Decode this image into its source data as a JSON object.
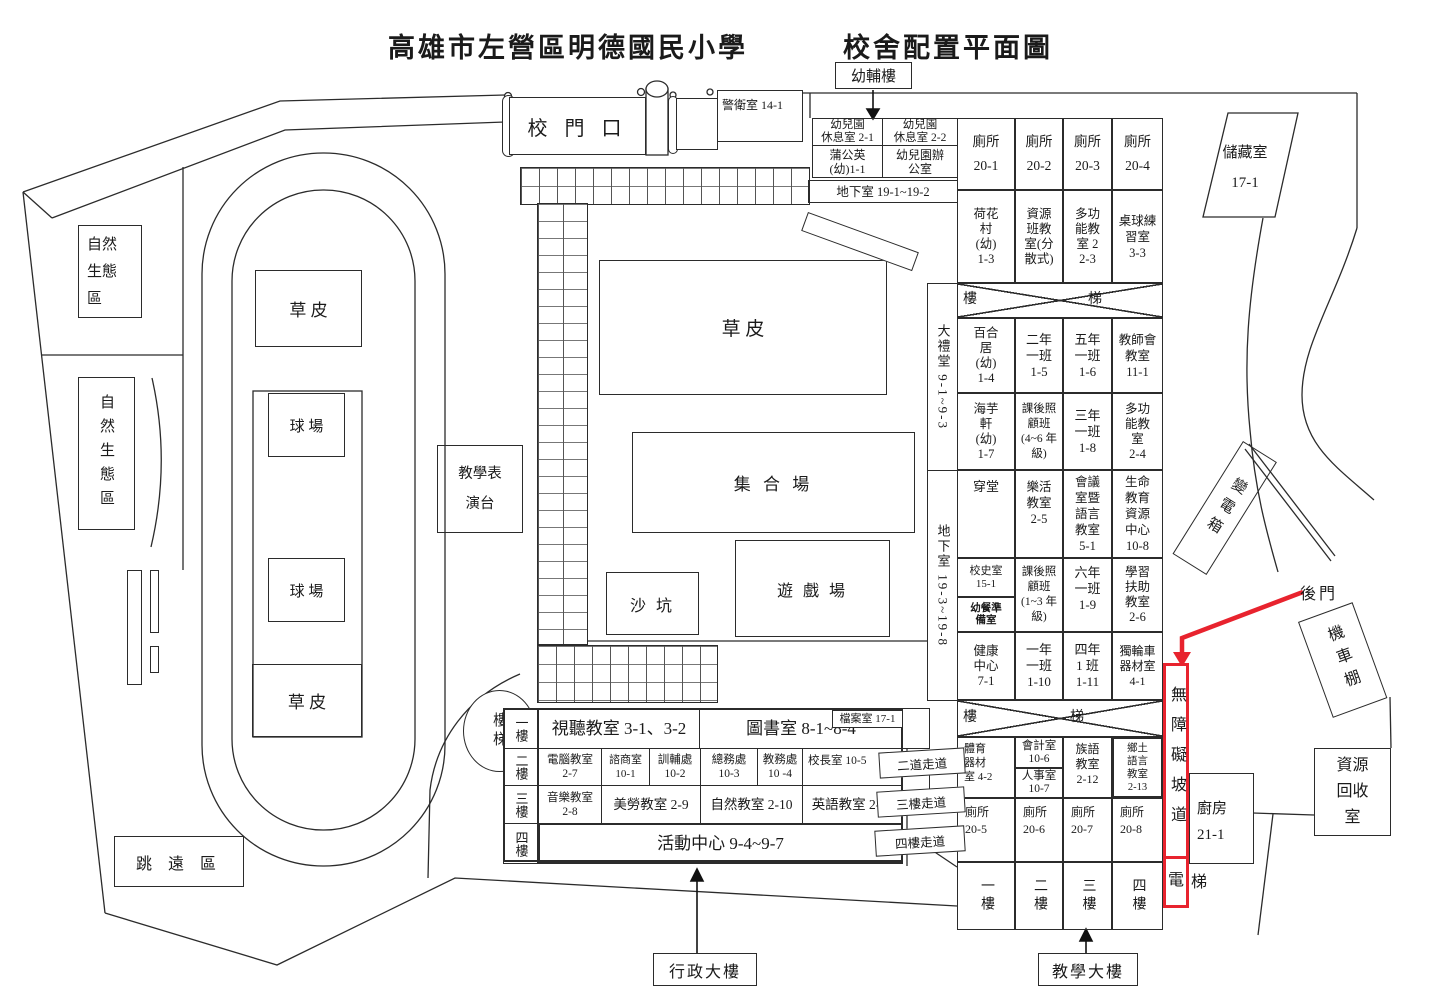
{
  "colors": {
    "ink": "#2b2b2b",
    "accent_red": "#e8232e"
  },
  "titles": {
    "school": "高雄市左營區明德國民小學",
    "map": "校舍配置平面圖"
  },
  "annotations": {
    "youfulou": "幼輔樓",
    "back_gate": "後門",
    "admin_building": "行政大樓",
    "teaching_building": "教學大樓"
  },
  "gate": {
    "banner": "校 門 口",
    "guard": "警衛室 14-1"
  },
  "fields": {
    "grass_track_top": "草    皮",
    "grass_track_bottom": "草    皮",
    "grass_center": "草    皮",
    "court1": "球 場",
    "court2": "球 場",
    "assembly": "集 合 場",
    "playground": "遊 戲 場",
    "sandbox": "沙 坑",
    "stage": "教學表\n演台",
    "eco1": "自然\n生態\n區",
    "eco2": "自然生態區",
    "jump": "跳 遠 區",
    "basement_1_2": "地下室 19-1~19-2"
  },
  "kindergarten": {
    "rest1": "幼兒園\n休息室 2-1",
    "rest2": "幼兒園\n休息室 2-2",
    "dandelion": "蒲公英\n(幼)1-1",
    "office": "幼兒園辦\n公室"
  },
  "side": {
    "hall": "大禮堂 9-1~9-3",
    "basement_3_8": "地下室 19-3~19-8"
  },
  "stairs": {
    "lou": "樓",
    "ti": "梯",
    "stair_circle": "樓梯"
  },
  "grid": {
    "r0": [
      "廁所\n20-1",
      "廁所\n20-2",
      "廁所\n20-3",
      "廁所\n20-4"
    ],
    "r1": [
      "荷花\n村\n(幼)\n1-3",
      "資源\n班教\n室(分\n散式)",
      "多功\n能教\n室 2\n2-3",
      "桌球練\n習室\n3-3"
    ],
    "r3": [
      "百合\n居\n(幼)\n1-4",
      "二年\n一班\n1-5",
      "五年\n一班\n1-6",
      "教師會\n教室\n11-1"
    ],
    "r4": [
      "海芋\n軒\n(幼)\n1-7",
      "課後照\n顧班\n(4~6 年\n級)",
      "三年\n一班\n1-8",
      "多功\n能教\n室\n2-4"
    ],
    "r5": [
      "穿堂",
      "樂活\n教室\n2-5",
      "會議\n室暨\n語言\n教室\n5-1",
      "生命\n教育\n資源\n中心\n10-8"
    ],
    "r6c0": [
      "校史室\n15-1",
      "幼餐準\n備室"
    ],
    "r6": [
      "課後照\n顧班\n(1~3 年\n級)",
      "六年\n一班\n1-9",
      "學習\n扶助\n教室\n2-6"
    ],
    "r7": [
      "健康\n中心\n7-1",
      "一年\n一班\n1-10",
      "四年\n1 班\n1-11",
      "獨輪車\n器材室\n4-1"
    ],
    "r9c0": "體育\n器材\n室 4-2",
    "r9c1": [
      "會計室\n10-6",
      "人事室\n10-7"
    ],
    "r9": [
      "族語\n教室\n2-12",
      "鄉土\n語言\n教室\n2-13"
    ],
    "r10": [
      "廁所\n20-5",
      "廁所\n20-6",
      "廁所\n20-7",
      "廁所\n20-8"
    ],
    "r11": [
      "一樓",
      "二樓",
      "三樓",
      "四樓"
    ]
  },
  "admin": {
    "floors": [
      "一樓",
      "二樓",
      "三樓",
      "四樓"
    ],
    "f1a": "視聽教室 3-1、3-2",
    "f1b": "圖書室 8-1~8-4",
    "archive": "檔案室 17-1",
    "f2": [
      "電腦教室\n2-7",
      "諮商室\n10-1",
      "訓輔處\n10-2",
      "總務處\n10-3",
      "教務處\n10 -4",
      "校長室 10-5"
    ],
    "f3": [
      "音樂教室\n2-8",
      "美勞教室 2-9",
      "自然教室 2-10",
      "英語教室 2-11"
    ],
    "f4": "活動中心 9-4~9-7",
    "walkways": [
      "二道走道",
      "三樓走道",
      "四樓走道"
    ]
  },
  "right_side": {
    "storage": "儲藏室\n17-1",
    "transformer": "變電箱",
    "moto_shed": "機車棚",
    "recycle": "資源\n回收\n室",
    "kitchen": "廚房\n21-1",
    "ramp": "無障礙坡道",
    "elevator_in": "電",
    "elevator_out": "梯"
  }
}
